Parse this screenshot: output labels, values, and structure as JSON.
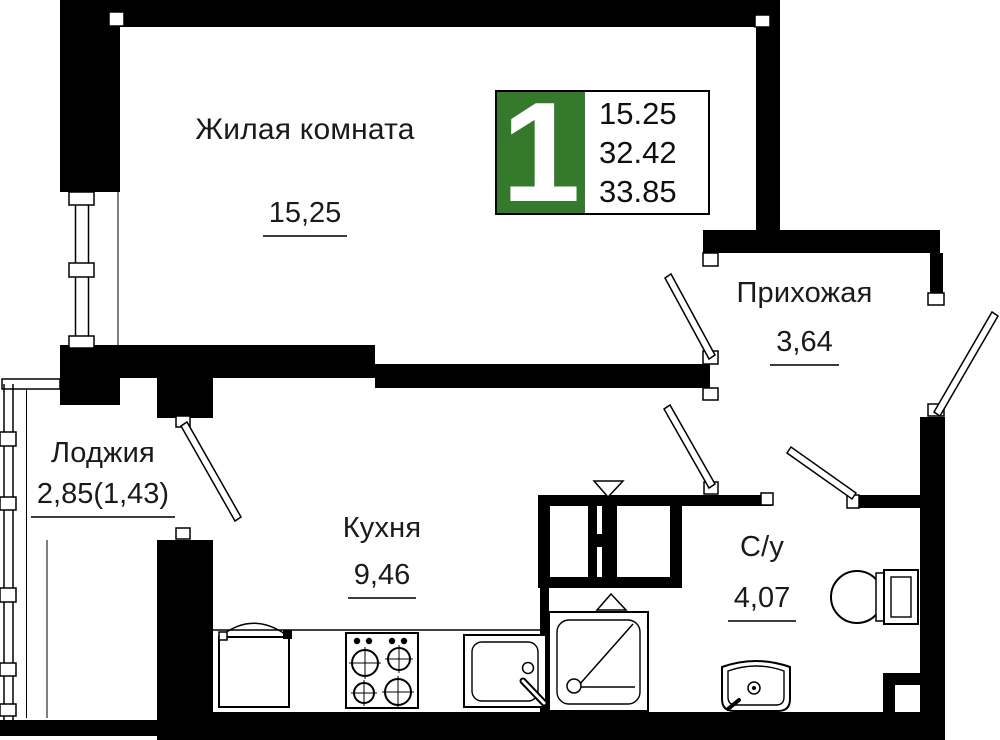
{
  "plan": {
    "title": "1-room apartment floor plan",
    "badge": {
      "room_count": "1",
      "stats": [
        "15.25",
        "32.42",
        "33.85"
      ],
      "accent_green": "#35792D"
    },
    "rooms": {
      "living": {
        "name": "Жилая комната",
        "area": "15,25"
      },
      "hallway": {
        "name": "Прихожая",
        "area": "3,64"
      },
      "loggia": {
        "name": "Лоджия",
        "area": "2,85(1,43)"
      },
      "kitchen": {
        "name": "Кухня",
        "area": "9,46"
      },
      "bathroom": {
        "name": "С/у",
        "area": "4,07"
      }
    },
    "fixtures": [
      "shower-tray",
      "toilet",
      "bathroom-sink",
      "kitchen-sink",
      "stove",
      "fridge",
      "vent-shaft"
    ],
    "colors": {
      "walls": "#000000",
      "background": "#ffffff",
      "underline": "#3c3c3c"
    }
  }
}
